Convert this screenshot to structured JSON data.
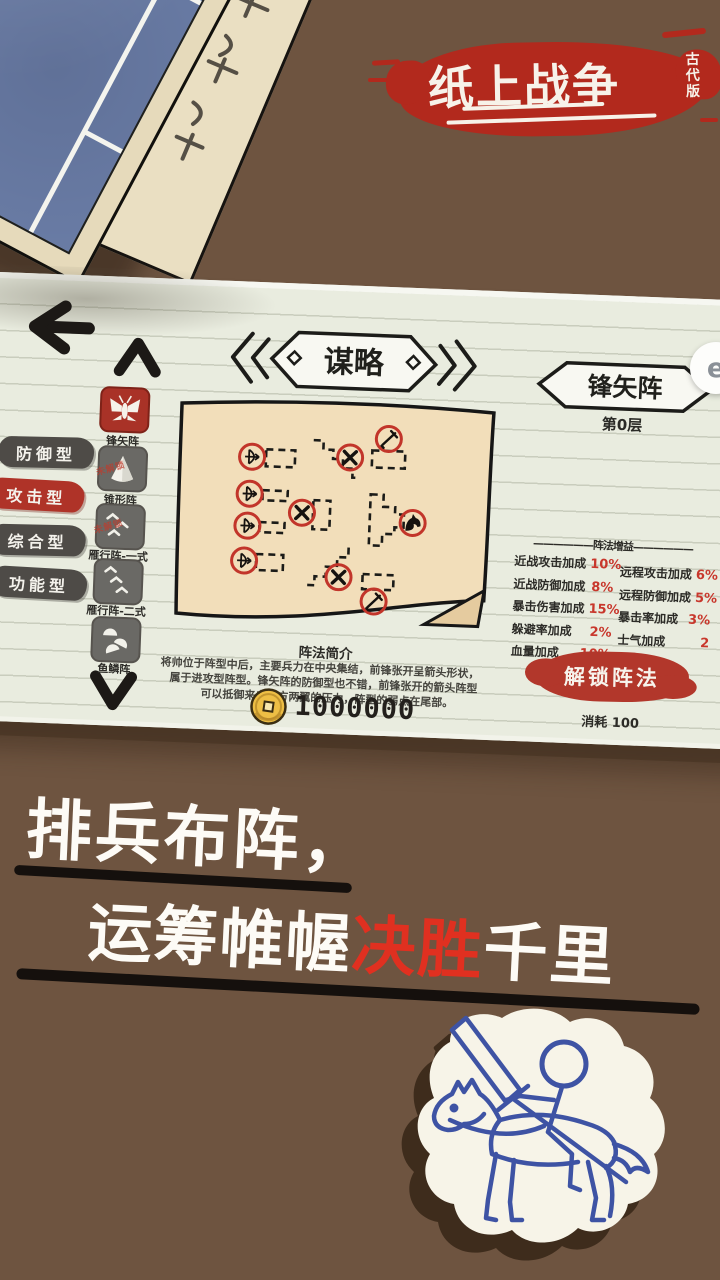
{
  "logo": {
    "title": "纸上战争",
    "edition": "古代版"
  },
  "panel": {
    "title_banner": "谋略",
    "formation_banner": "锋矢阵",
    "layer": "第0层",
    "categories": [
      {
        "label": "防御型",
        "active": false
      },
      {
        "label": "攻击型",
        "active": true
      },
      {
        "label": "综合型",
        "active": false
      },
      {
        "label": "功能型",
        "active": false
      }
    ],
    "formations": [
      {
        "label": "锋矢阵",
        "selected": true
      },
      {
        "label": "锥形阵",
        "selected": false,
        "stamp": "未解锁"
      },
      {
        "label": "雁行阵-一式",
        "selected": false,
        "stamp": "未解锁"
      },
      {
        "label": "雁行阵-二式",
        "selected": false
      },
      {
        "label": "鱼鳞阵",
        "selected": false
      }
    ],
    "bonuses": {
      "header": "——————阵法增益——————",
      "left": [
        {
          "label": "近战攻击加成",
          "value": "10%"
        },
        {
          "label": "近战防御加成",
          "value": "8%"
        },
        {
          "label": "暴击伤害加成",
          "value": "15%"
        },
        {
          "label": "躲避率加成",
          "value": "2%"
        },
        {
          "label": "血量加成",
          "value": "10%"
        }
      ],
      "right": [
        {
          "label": "远程攻击加成",
          "value": "6%"
        },
        {
          "label": "远程防御加成",
          "value": "5%"
        },
        {
          "label": "暴击率加成",
          "value": "3%"
        },
        {
          "label": "士气加成",
          "value": "2"
        }
      ]
    },
    "intro": {
      "title": "阵法简介",
      "line1": "将帅位于阵型中后，主要兵力在中央集结，前锋张开呈箭头形状，",
      "line2": "属于进攻型阵型。锋矢阵的防御型也不错，前锋张开的箭头阵型",
      "line3": "可以抵御来自敌方两翼的压力，阵型的弱点在尾部。"
    },
    "currency": "1000000",
    "unlock": {
      "button": "解锁阵法",
      "cost": "消耗 100"
    }
  },
  "overlay": {
    "floating_button": "e"
  },
  "tagline": {
    "line1": "排兵布阵，",
    "line2a": "运筹帷幄",
    "line2b": "决胜",
    "line2c": "千里"
  }
}
